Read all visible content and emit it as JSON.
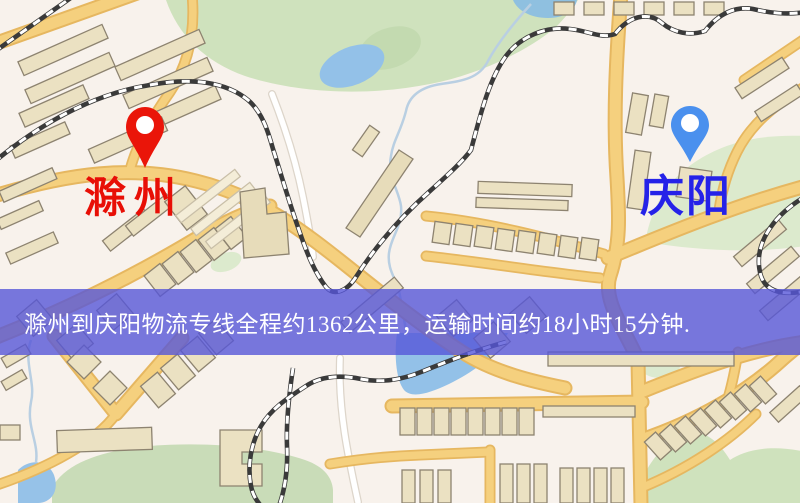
{
  "page": {
    "width": 800,
    "height": 503,
    "kind": "logistics-route-map-image"
  },
  "map": {
    "origin": {
      "label": "滁州",
      "icon": "location-pin",
      "pin_color": "#ea1509",
      "pin_inner_color": "#ffffff",
      "label_color": "#e80f06"
    },
    "destination": {
      "label": "庆阳",
      "icon": "location-pin",
      "pin_color": "#4a90ee",
      "pin_inner_color": "#ffffff",
      "label_color": "#2522e8"
    },
    "banner": {
      "text": "滁州到庆阳物流专线全程约1362公里，运输时间约18小时15分钟.",
      "distance_text": "约1362公里",
      "duration_text": "约18小时15分钟",
      "background_color": "rgba(86,86,216,0.80)",
      "text_color": "#ffffff"
    },
    "palette": {
      "background": "#f8f2ec",
      "road_fill": "#f5d07e",
      "road_casing": "#e6b760",
      "building": "#ebe1c2",
      "building_outline": "#8d8370",
      "park": "#cfe2bd",
      "park_light": "#dceacd",
      "water": "#93c1e8",
      "railway": "#3a3a3a"
    }
  }
}
